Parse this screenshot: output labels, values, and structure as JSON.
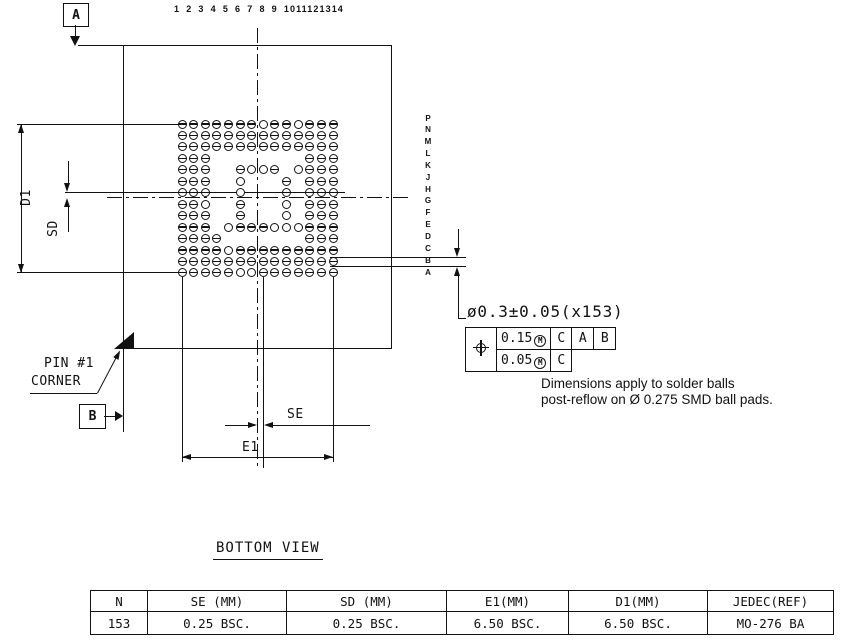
{
  "drawing": {
    "datum_a_label": "A",
    "datum_b_label": "B",
    "column_numbers_text": "1 2 3 4 5 6 7 8 9 1011121314",
    "row_letters": [
      "P",
      "N",
      "M",
      "L",
      "K",
      "J",
      "H",
      "G",
      "F",
      "E",
      "D",
      "C",
      "B",
      "A"
    ],
    "dim_d1": "D1",
    "dim_sd": "SD",
    "dim_se": "SE",
    "dim_e1": "E1",
    "pin1_line1": "PIN #1",
    "pin1_line2": "CORNER",
    "ball_callout": "ø0.3±0.05(x153)",
    "tolerance_frame": {
      "symbol": "position",
      "rows": [
        {
          "value": "0.15",
          "modifier": "M",
          "datums": [
            "C",
            "A",
            "B"
          ]
        },
        {
          "value": "0.05",
          "modifier": "M",
          "datums": [
            "C"
          ]
        }
      ]
    },
    "note_line1": "Dimensions apply to solder balls",
    "note_line2": "post-reflow on Ø 0.275 SMD ball pads.",
    "view_label": "BOTTOM VIEW",
    "ball_grid": {
      "columns": 14,
      "rows": 14,
      "ball_count": 153,
      "pattern": [
        "XXXXXXXOXXOXXX",
        "XXXXXXXXXXXXXX",
        "XXXXXXXXXXXXXX",
        "XXX........XXX",
        "XXX..XOOX.OXXX",
        "XXX..O...X.XXX",
        "XXX..O...X.XXX",
        "XXO..X...O.XXX",
        "XXX..X...O.XXX",
        "XXX.OXXXOOOXXX",
        "XXXX.......XXX",
        "XXXXOXXXXXXXXX",
        "XXXXXXXXXXXXXX",
        "XXXXXOOXXXXXXX"
      ]
    }
  },
  "table": {
    "headers": [
      "N",
      "SE (MM)",
      "SD (MM)",
      "E1(MM)",
      "D1(MM)",
      "JEDEC(REF)"
    ],
    "values": [
      "153",
      "0.25 BSC.",
      "0.25 BSC.",
      "6.50 BSC.",
      "6.50 BSC.",
      "MO-276 BA"
    ]
  },
  "colors": {
    "ink": "#111111",
    "background": "#ffffff"
  }
}
